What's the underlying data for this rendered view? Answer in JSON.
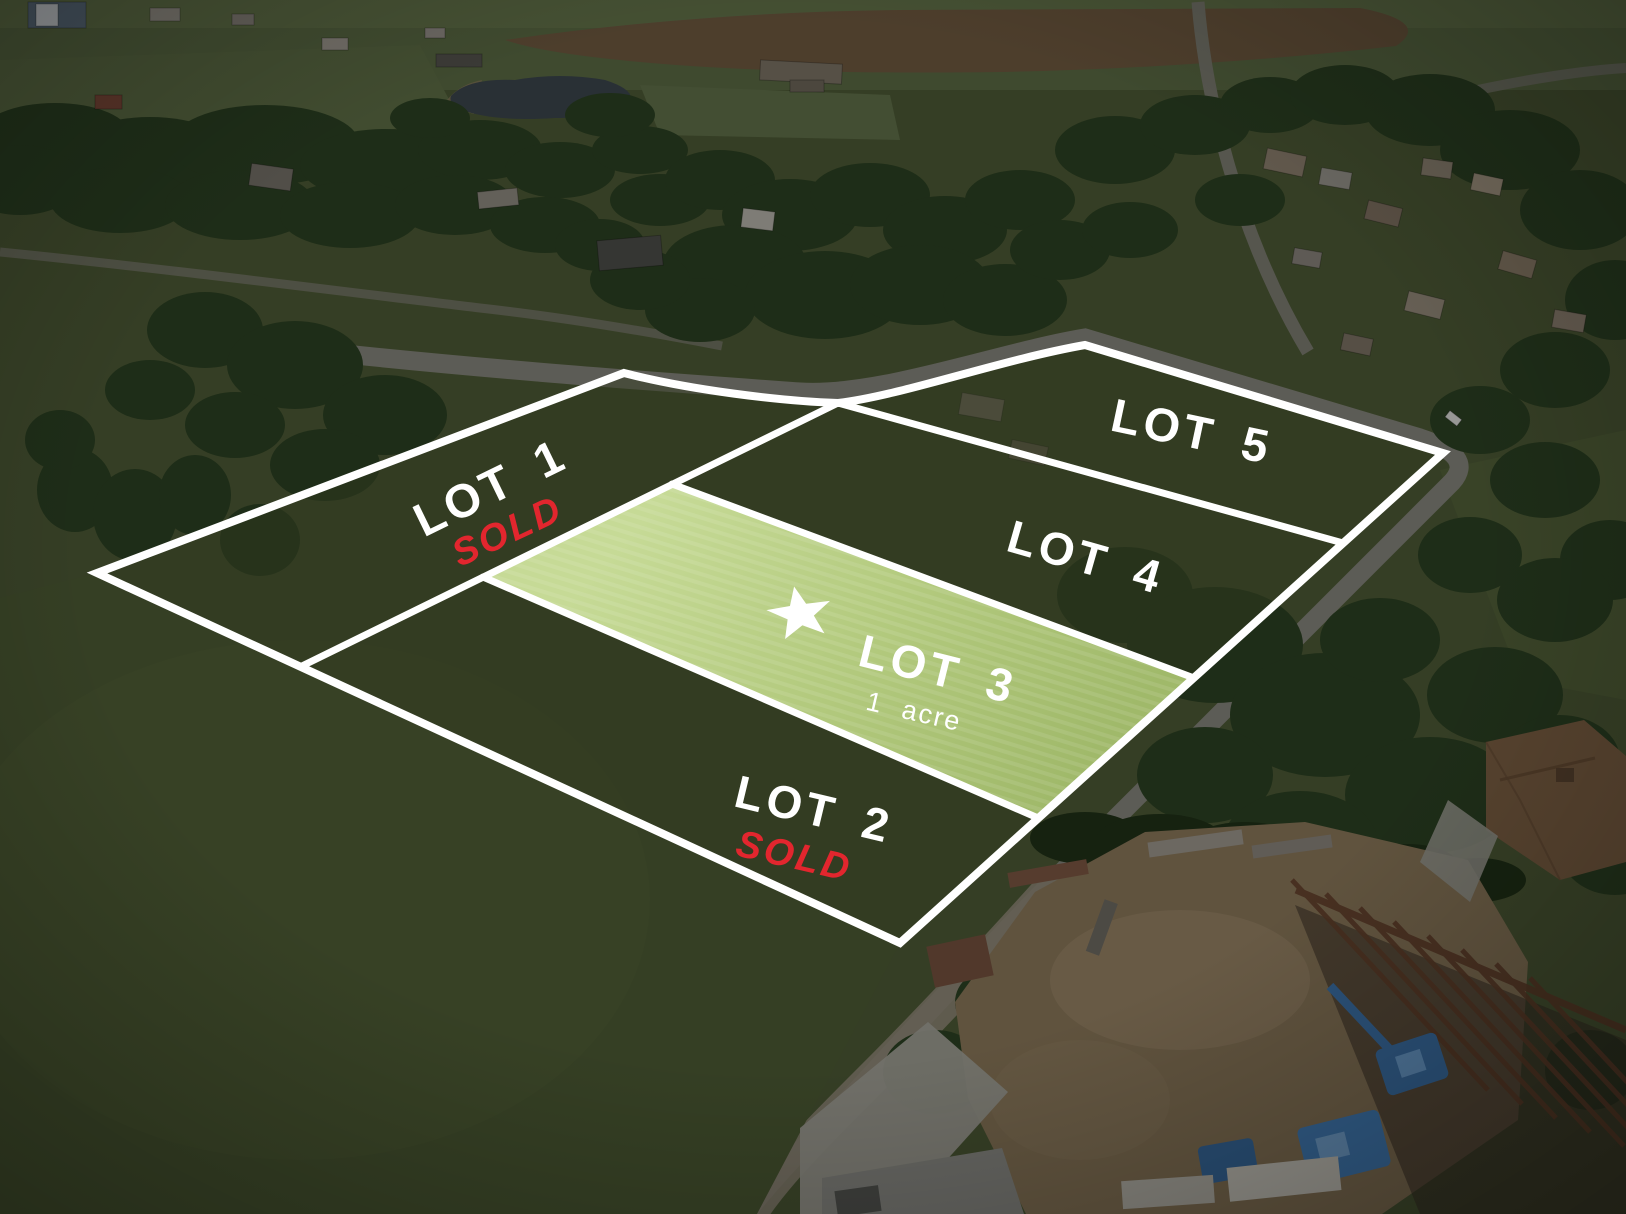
{
  "lots": [
    {
      "label": "LOT 1",
      "status": "SOLD"
    },
    {
      "label": "LOT 2",
      "status": "SOLD"
    },
    {
      "label": "LOT 3",
      "size": "1 acre",
      "highlighted": true,
      "marker_icon": "star-icon"
    },
    {
      "label": "LOT 4"
    },
    {
      "label": "LOT 5"
    }
  ],
  "colors": {
    "boundary_line": "#ffffff",
    "sold_label": "#e2262e",
    "lot3_highlight": "#b3ca7e",
    "label_text": "#ffffff"
  }
}
